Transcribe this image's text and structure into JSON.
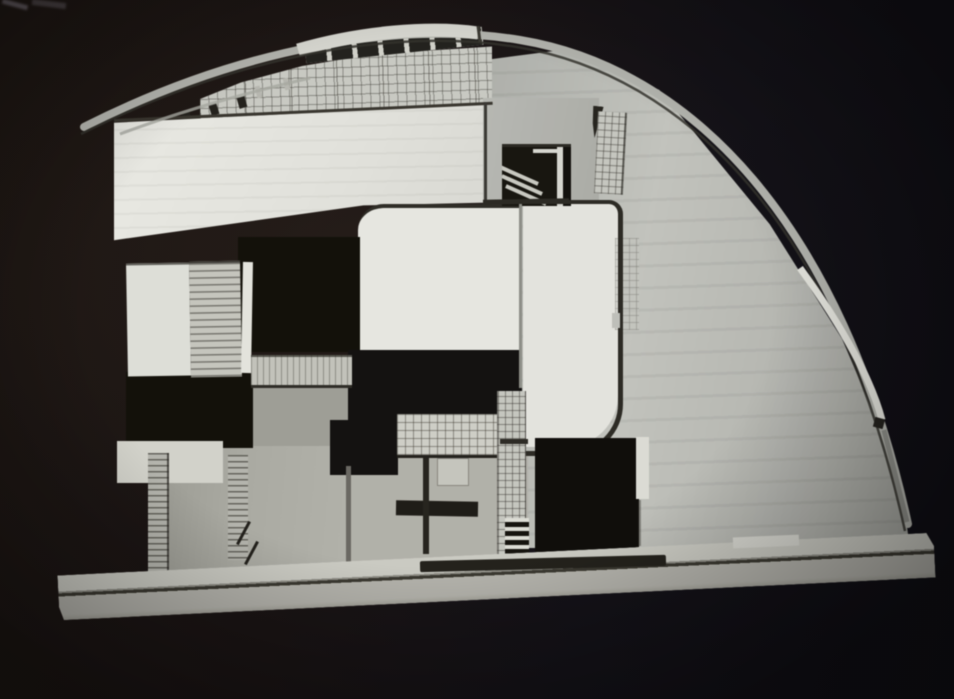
{
  "scene": {
    "description": "Photograph of a white architectural section model with a large quarter-arc curved roof, displayed against a dark backdrop",
    "visible_text": "none"
  },
  "palette": {
    "backdrop_warm_dark": "#1d1713",
    "backdrop_cool_dark": "#121117",
    "model_white": "#e8e8e2",
    "model_light_gray": "#c3c4be",
    "model_mid_gray": "#aaaaa2",
    "shadow_line_dark": "#2e2c26",
    "opening_black": "#100e0b"
  },
  "elements": [
    "curved-roof-band",
    "apex-fascia",
    "clerestory-band",
    "glass-block-wall",
    "upper-left-wall",
    "stair-window",
    "glass-grid-strip",
    "center-white-volume",
    "rounded-outline-volume",
    "louvered-block",
    "dark-openings",
    "tiled-panel",
    "tiled-pier",
    "stair-treads",
    "ladder-wall",
    "base-plinth",
    "base-groove"
  ]
}
